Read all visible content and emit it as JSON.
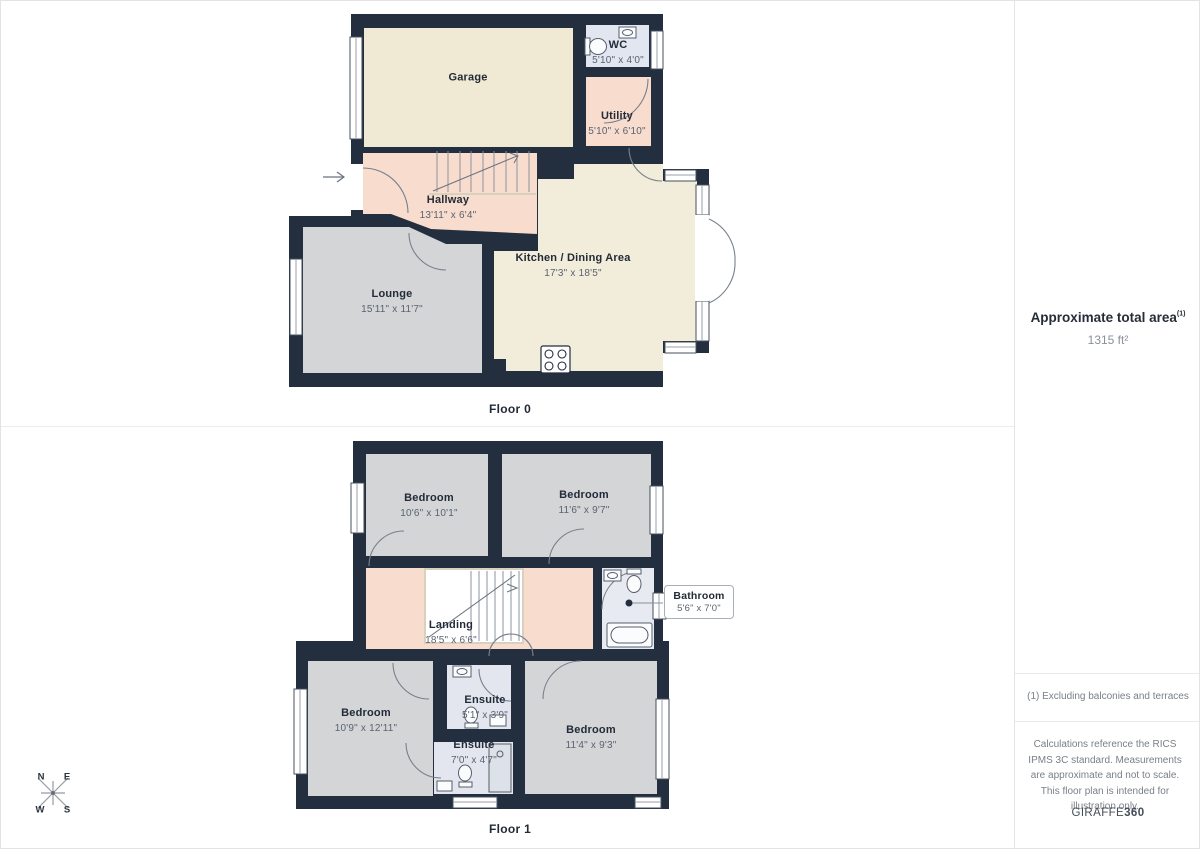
{
  "floor0": {
    "label": "Floor 0",
    "rooms": {
      "garage": {
        "name": "Garage",
        "dims": ""
      },
      "wc": {
        "name": "WC",
        "dims": "5'10\" x 4'0\""
      },
      "utility": {
        "name": "Utility",
        "dims": "5'10\" x 6'10\""
      },
      "hallway": {
        "name": "Hallway",
        "dims": "13'11\" x 6'4\""
      },
      "kitchen": {
        "name": "Kitchen / Dining Area",
        "dims": "17'3\" x 18'5\""
      },
      "lounge": {
        "name": "Lounge",
        "dims": "15'11\" x 11'7\""
      }
    }
  },
  "floor1": {
    "label": "Floor 1",
    "rooms": {
      "bedroom_top_left": {
        "name": "Bedroom",
        "dims": "10'6\" x 10'1\""
      },
      "bedroom_top_right": {
        "name": "Bedroom",
        "dims": "11'6\" x 9'7\""
      },
      "landing": {
        "name": "Landing",
        "dims": "18'5\" x 6'6\""
      },
      "bathroom": {
        "name": "Bathroom",
        "dims": "5'6\" x 7'0\""
      },
      "bedroom_bottom_left": {
        "name": "Bedroom",
        "dims": "10'9\" x 12'11\""
      },
      "ensuite_upper": {
        "name": "Ensuite",
        "dims": "5'1\" x 3'9\""
      },
      "ensuite_lower": {
        "name": "Ensuite",
        "dims": "7'0\" x 4'7\""
      },
      "bedroom_bottom_right": {
        "name": "Bedroom",
        "dims": "11'4\" x 9'3\""
      }
    }
  },
  "sidebar": {
    "area_title": "Approximate total area",
    "area_sup": "(1)",
    "area_value": "1315 ft²",
    "footnote": "(1) Excluding balconies and terraces",
    "disclaimer": "Calculations reference the RICS IPMS 3C standard. Measurements are approximate and not to scale. This floor plan is intended for illustration only.",
    "brand_name": "GIRAFFE",
    "brand_suffix": "360"
  },
  "compass": {
    "n": "N",
    "e": "E",
    "s": "S",
    "w": "W"
  },
  "colors": {
    "wall": "#232e3e",
    "garage_floor": "#f0e9d3",
    "kitchen_floor": "#f2ecda",
    "pink_floor": "#f8dccd",
    "gray_floor": "#d3d5d7",
    "wc_floor": "#e2e6f0",
    "bathroom_floor": "#e7eaf1",
    "ensuite_floor": "#e3e6ee",
    "divider": "#ececee"
  }
}
